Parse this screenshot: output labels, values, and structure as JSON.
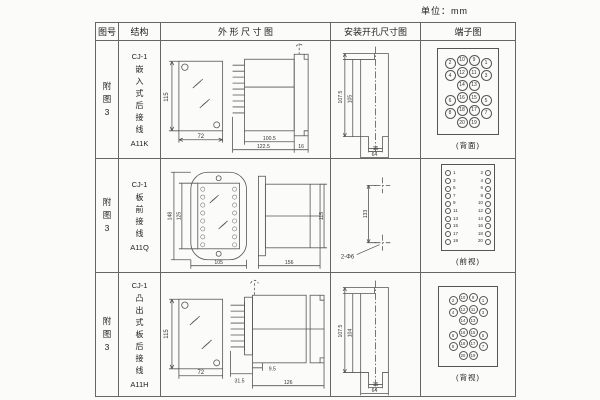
{
  "unit_label": "单位：mm",
  "headers": {
    "fig_no": "图号",
    "structure": "结构",
    "outline": "外 形 尺 寸 图",
    "mounting": "安装开孔尺寸图",
    "terminal": "端子图"
  },
  "rows": [
    {
      "fig_no": "附图3",
      "model": "CJ-1",
      "desc": "嵌入式后接线",
      "code": "A11K",
      "dims": {
        "front_h": "115",
        "front_w": "72",
        "body": "100.5",
        "total": "122.5",
        "flange": "16"
      },
      "mount": {
        "outer_h": "107.5",
        "inner_h": "105",
        "slot_w": "16",
        "outer_w": "64"
      },
      "terminal_label": "(背面)",
      "terminal_rows": [
        [
          "2",
          "10",
          "9",
          "1"
        ],
        [
          "4",
          "12",
          "11",
          "3"
        ],
        [
          "14",
          "13"
        ],
        [
          "6",
          "16",
          "15",
          "5"
        ],
        [
          "8",
          "18",
          "17",
          "7"
        ],
        [
          "20",
          "19"
        ]
      ]
    },
    {
      "fig_no": "附图3",
      "model": "CJ-1",
      "desc": "板前接线",
      "code": "A11Q",
      "dims": {
        "front_h": "148",
        "window_h": "125",
        "front_w": "105",
        "side_l": "156",
        "side_h": "115"
      },
      "mount": {
        "spacing": "133",
        "holes": "2-Φ6"
      },
      "terminal_label": "(前视)",
      "terminal_pairs": [
        [
          "1",
          "2"
        ],
        [
          "3",
          "4"
        ],
        [
          "5",
          "6"
        ],
        [
          "7",
          "8"
        ],
        [
          "9",
          "10"
        ],
        [
          "11",
          "12"
        ],
        [
          "13",
          "14"
        ],
        [
          "15",
          "16"
        ],
        [
          "17",
          "18"
        ],
        [
          "19",
          "20"
        ]
      ]
    },
    {
      "fig_no": "附图3",
      "model": "CJ-1",
      "desc": "凸出式板后接线",
      "code": "A11H",
      "dims": {
        "front_h": "115",
        "front_w": "72",
        "pins": "31.5",
        "offset": "9.5",
        "body": "126"
      },
      "mount": {
        "outer_h": "107.5",
        "inner_h": "104",
        "slot_w": "16",
        "outer_w": "64"
      },
      "terminal_label": "(背视)",
      "terminal_rows": [
        [
          "2",
          "10",
          "9",
          "1"
        ],
        [
          "4",
          "12",
          "11",
          "3"
        ],
        [
          "14",
          "13"
        ],
        [
          "6",
          "16",
          "15",
          "5"
        ],
        [
          "8",
          "18",
          "17",
          "7"
        ],
        [
          "20",
          "19"
        ]
      ]
    }
  ]
}
